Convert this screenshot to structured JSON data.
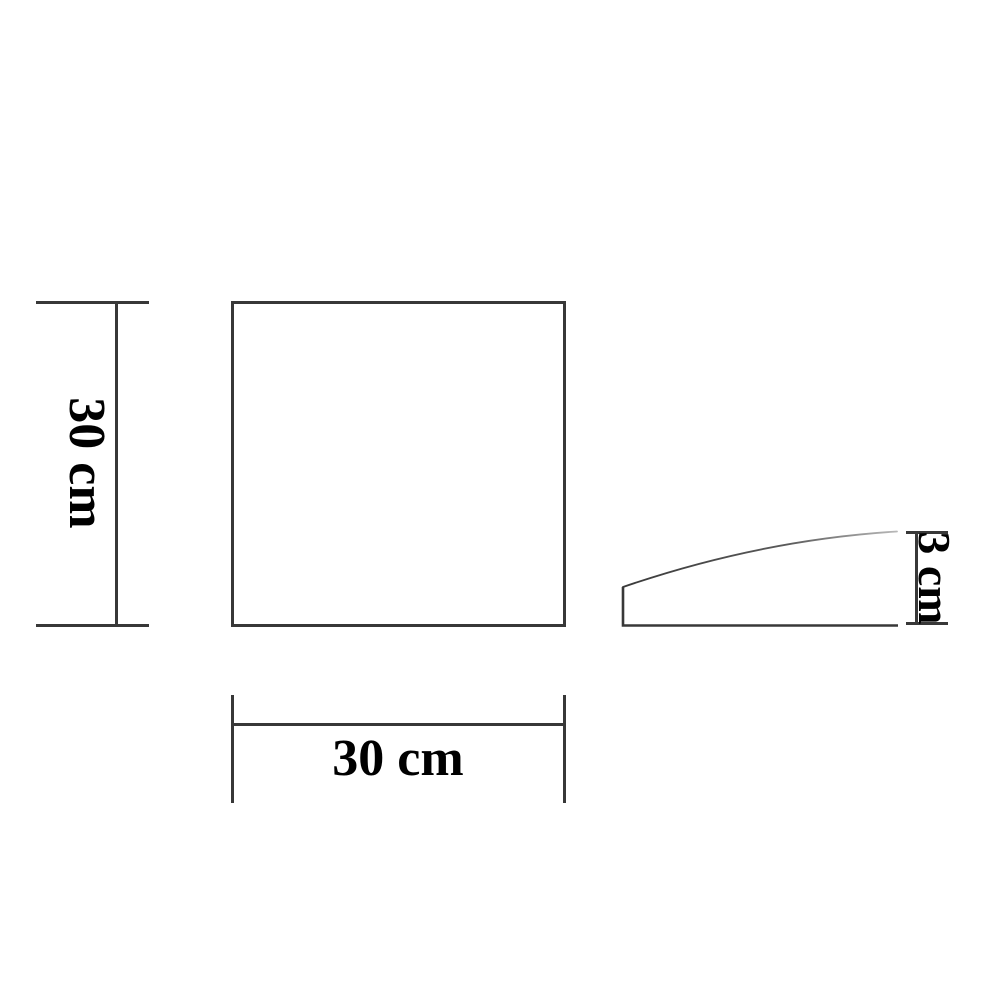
{
  "diagram": {
    "type": "technical-drawing",
    "views": {
      "front": {
        "shape": "square",
        "height_label": "30 cm",
        "width_label": "30 cm",
        "height_value_cm": 30,
        "width_value_cm": 30
      },
      "side": {
        "shape": "curved-wedge-profile",
        "height_label": "3 cm",
        "height_value_cm": 3
      }
    }
  },
  "colors": {
    "background": "#ffffff",
    "line": "#383838",
    "text": "#000000",
    "curve_fade_start": "#3a3a3a",
    "curve_fade_end": "#b8b8b8"
  }
}
